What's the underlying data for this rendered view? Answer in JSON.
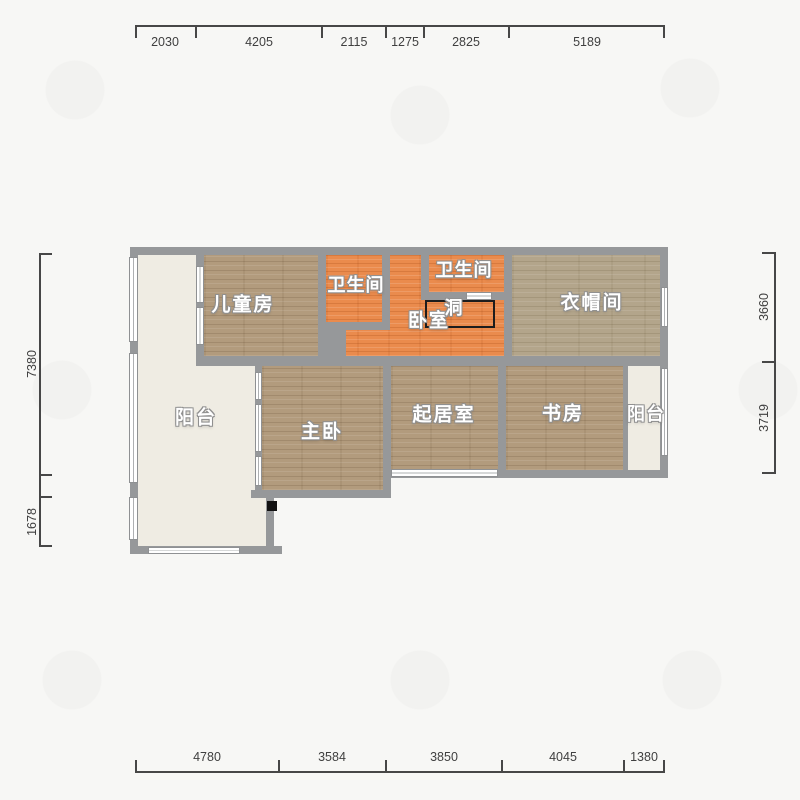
{
  "rooms": {
    "children_room": {
      "label": "儿童房"
    },
    "bathroom_left": {
      "label": "卫生间"
    },
    "bathroom_right": {
      "label": "卫生间"
    },
    "bedroom": {
      "label": "卧室"
    },
    "hole": {
      "label": "洞"
    },
    "cloakroom": {
      "label": "衣帽间"
    },
    "balcony_left": {
      "label": "阳台"
    },
    "master_bedroom": {
      "label": "主卧"
    },
    "living_room": {
      "label": "起居室"
    },
    "study": {
      "label": "书房"
    },
    "balcony_right": {
      "label": "阳台"
    }
  },
  "dimensions": {
    "top": [
      "2030",
      "4205",
      "2115",
      "1275",
      "2825",
      "5189"
    ],
    "bottom": [
      "4780",
      "3584",
      "3850",
      "4045",
      "1380"
    ],
    "left": [
      "7380",
      "1678"
    ],
    "right": [
      "3660",
      "3719"
    ]
  },
  "colors": {
    "wall": "#96989a",
    "wood_floor": "#b29b7d",
    "cloakroom_floor": "#b3a58b",
    "tile_orange": "#ea8b4d",
    "balcony_floor": "#efece3",
    "dimension_text": "#3f3f3f"
  }
}
